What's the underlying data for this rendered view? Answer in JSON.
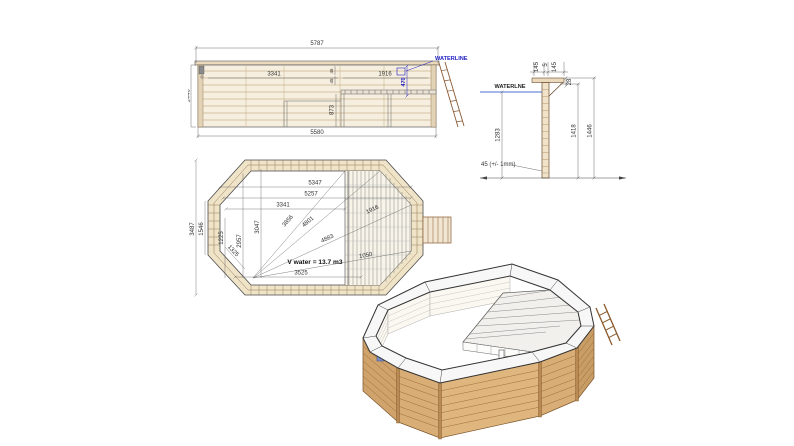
{
  "elevation": {
    "waterline_label": "WATERLINE",
    "dims": {
      "overall_width": "5787",
      "height": "1446",
      "open_length": "3341",
      "rim_a": "45",
      "rim_b": "45",
      "deck_length": "1916",
      "waterline_offset": "470",
      "deck_height": "873",
      "base_width": "5580"
    }
  },
  "section": {
    "waterline_label": "WATERLNE",
    "dims": {
      "cap_left": "145",
      "cap_gap": "5",
      "cap_right": "145",
      "cap_drop": "28",
      "water_depth": "1283",
      "inner_height": "1418",
      "total_height": "1446",
      "plank_note": "45 (+/- 1mm)"
    }
  },
  "plan": {
    "volume_label": "V water = 13.7 m3",
    "dims": {
      "inner_length_a": "5347",
      "inner_length_b": "5257",
      "open_length": "3341",
      "deck_diag": "1916",
      "diag_a": "3856",
      "diag_b": "4801",
      "diag_c": "4883",
      "overall_width": "3487",
      "side_length": "1546",
      "inner_side": "1225",
      "corner": "1325",
      "vert_a": "2957",
      "vert_b": "3047",
      "bottom_length": "3525",
      "deck_width": "1050"
    }
  }
}
